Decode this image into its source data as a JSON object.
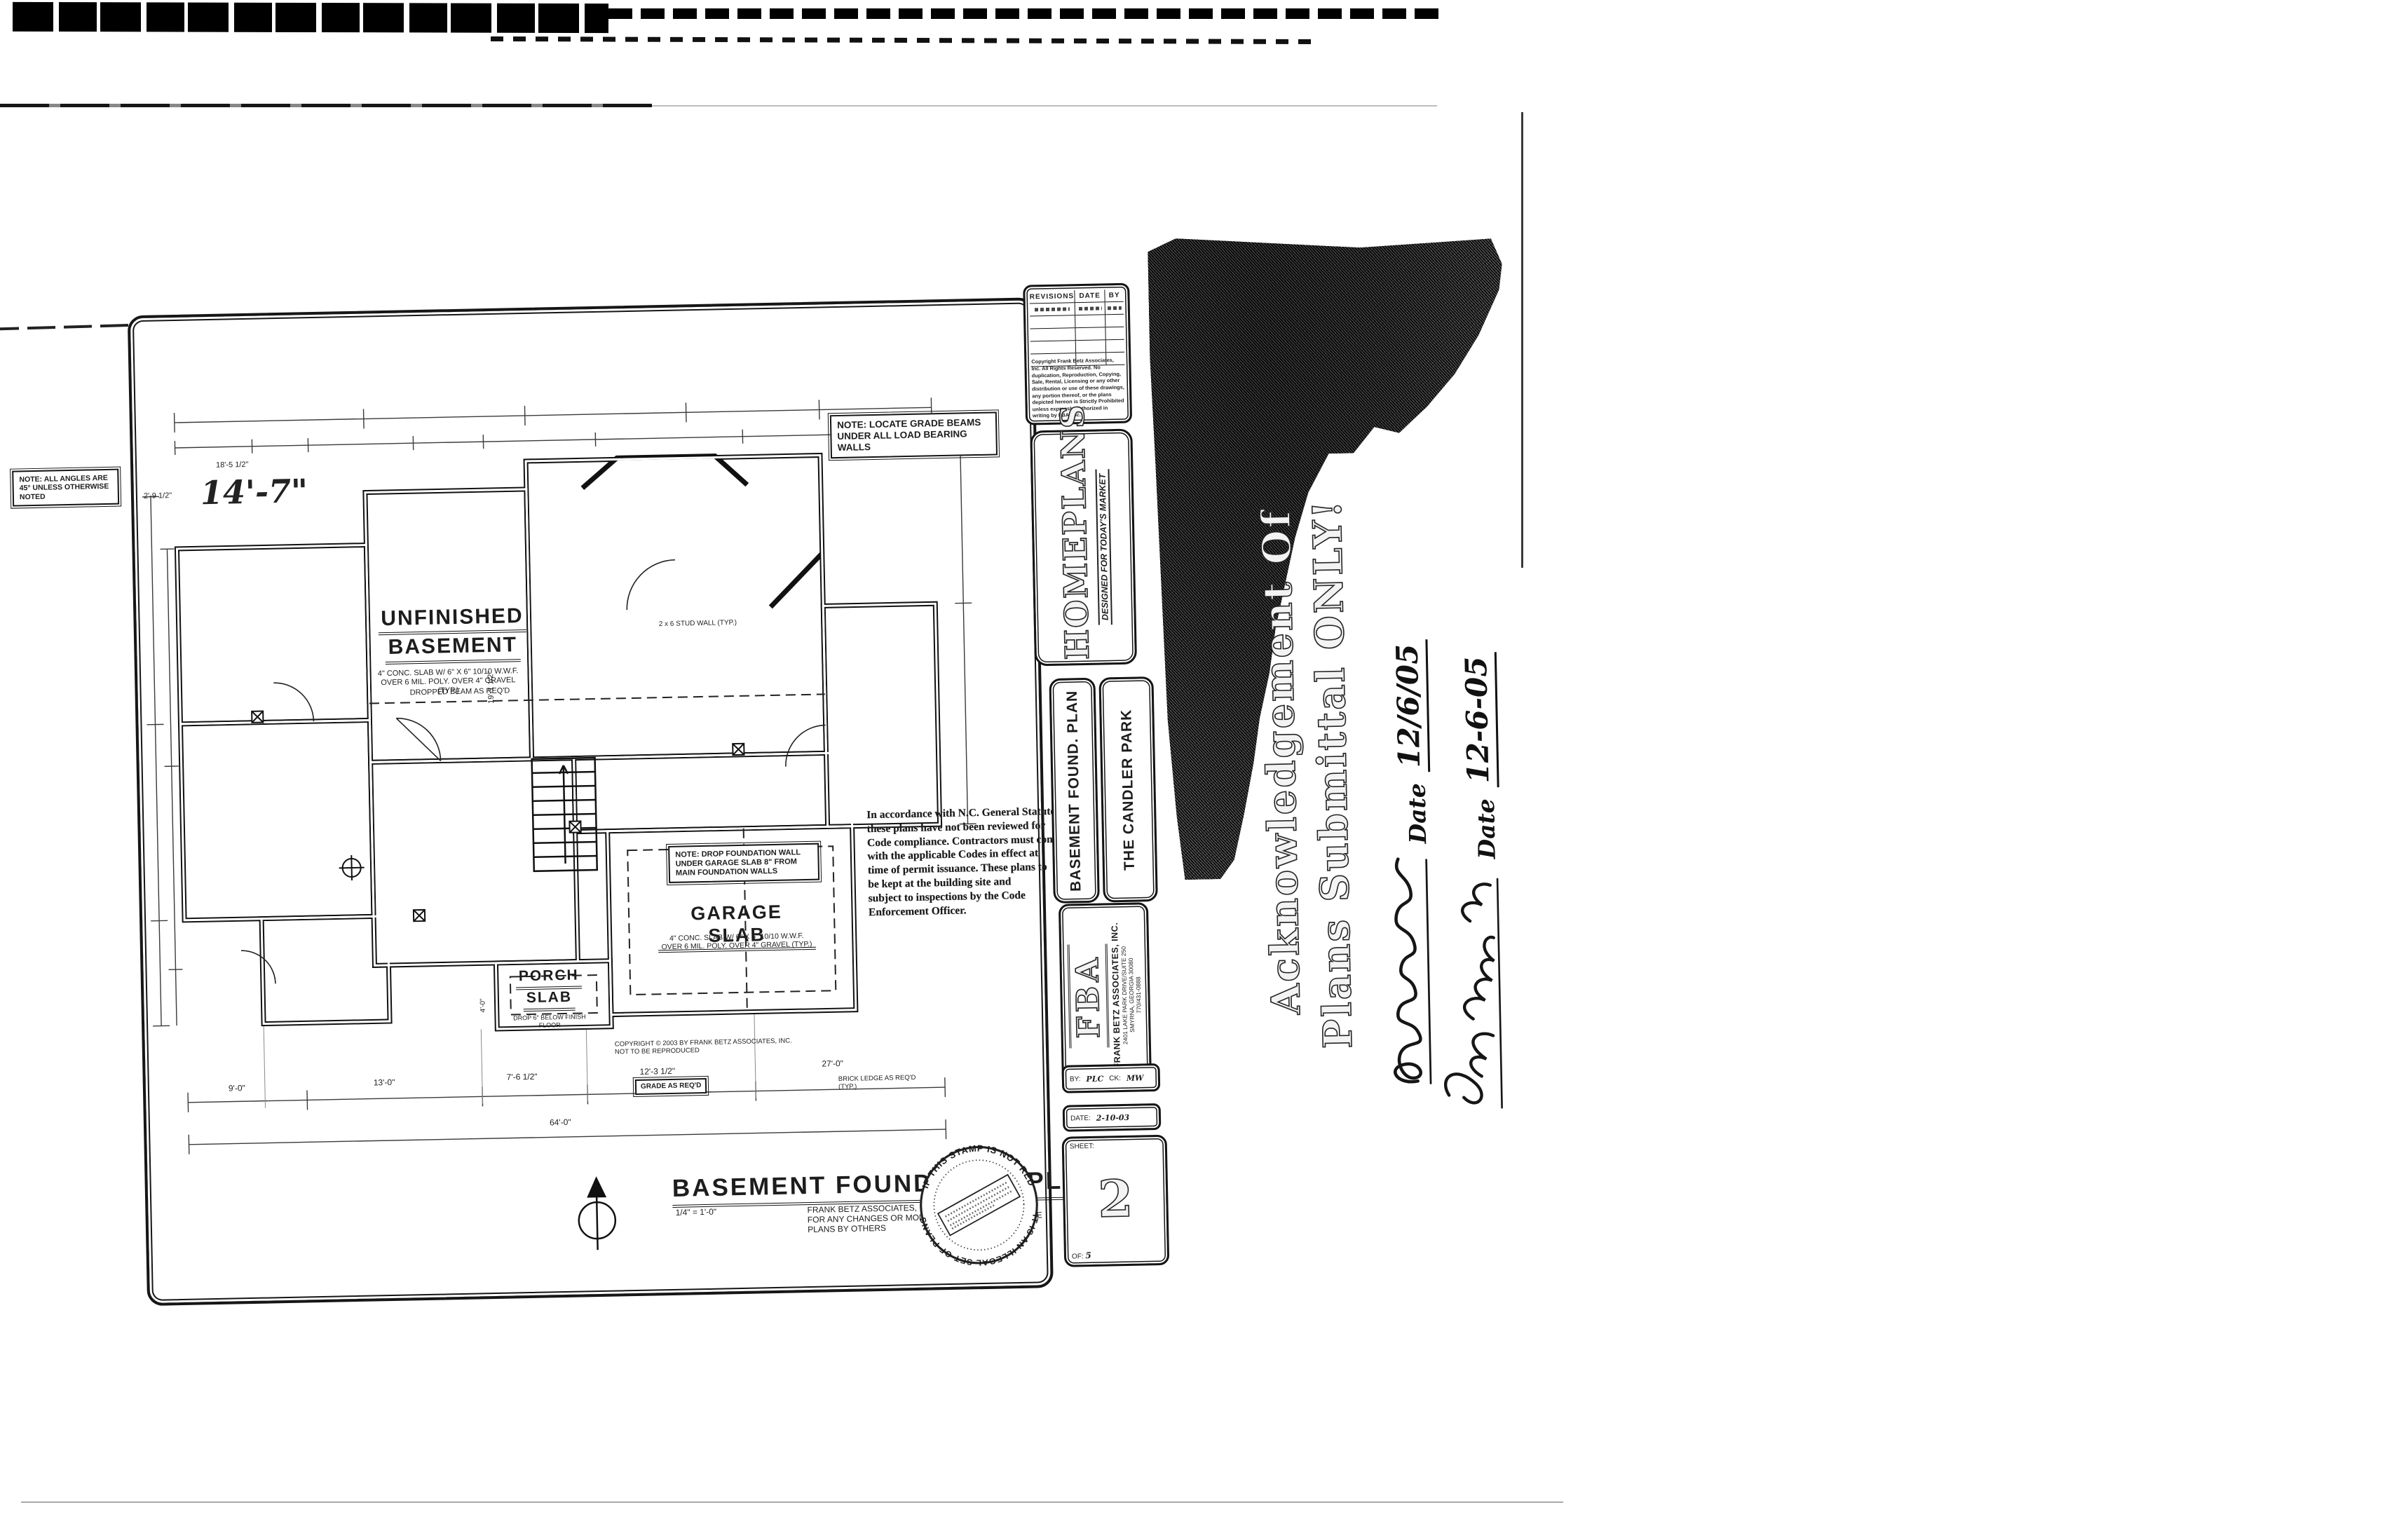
{
  "plan": {
    "handwritten_dim": "14'-7\"",
    "notes": {
      "angles": "NOTE: ALL ANGLES ARE 45° UNLESS OTHERWISE NOTED",
      "grade_beams": "NOTE: LOCATE GRADE BEAMS UNDER ALL LOAD BEARING WALLS",
      "garage_drop": "NOTE: DROP FOUNDATION WALL UNDER GARAGE SLAB 8\" FROM MAIN FOUNDATION WALLS",
      "dropped_beam": "DROPPED BEAM AS REQ'D",
      "stud_wall": "2 x 6 STUD WALL (TYP.)",
      "grade": "GRADE AS REQ'D",
      "brick_ledge": "BRICK LEDGE AS REQ'D (TYP.)",
      "copyright": "COPYRIGHT © 2003 BY FRANK BETZ ASSOCIATES, INC. NOT TO BE REPRODUCED"
    },
    "rooms": {
      "unfinished": {
        "lines": [
          "UNFINISHED",
          "BASEMENT"
        ],
        "note": "4\" CONC. SLAB W/ 6\" X 6\" 10/10 W.W.F. OVER 6 MIL. POLY. OVER 4\" GRAVEL (TYP.)"
      },
      "garage": {
        "lines": [
          "GARAGE SLAB"
        ],
        "note": "4\" CONC. SLAB W/ 6\" X 6\" 10/10 W.W.F. OVER 6 MIL. POLY. OVER 4\" GRAVEL (TYP.)"
      },
      "porch": {
        "lines": [
          "PORCH",
          "SLAB"
        ],
        "note": "DROP 6\" BELOW FINISH FLOOR"
      }
    },
    "dims": {
      "bottom": [
        "9'-0\"",
        "13'-0\"",
        "7'-6 1/2\"",
        "12'-3 1/2\"",
        "27'-0\"",
        "64'-0\""
      ],
      "top_small": "18'-5 1/2\"",
      "left_small": "2'-9 1/2\"",
      "interior_vertical": "19'-1 1/2\"",
      "porch_depth": "4'-0\""
    },
    "title": {
      "text": "BASEMENT FOUNDATION PLAN",
      "scale": "1/4\" = 1'-0\"",
      "disclaimer_lines": [
        "FRANK BETZ ASSOCIATES, INC. ASSUMES NO LIABILITY",
        "FOR ANY CHANGES OR MODIFICATIONS MADE TO THESE",
        "PLANS BY OTHERS"
      ]
    }
  },
  "code_stamp": {
    "lines": [
      "In accordance with N.C. General Statutes",
      "these plans have not been reviewed for",
      "Code compliance. Contractors must comply",
      "with the applicable Codes in effect at",
      "time of permit issuance. These plans to",
      "be kept at the building site and",
      "subject to inspections by the Code",
      "Enforcement Officer."
    ]
  },
  "titleblock": {
    "revisions": {
      "headers": [
        "REVISIONS",
        "DATE",
        "BY"
      ]
    },
    "copyright": "Copyright Frank Betz Associates, Inc. All Rights Reserved. No duplication, Reproduction, Copying, Sale, Rental, Licensing or any other distribution or use of these drawings, any portion thereof, or the plans depicted hereon is Strictly Prohibited unless expressly authorized in writing by FBA, Inc.",
    "brand": {
      "name": "HOMEPLANS",
      "tagline": "DESIGNED FOR TODAY'S MARKET"
    },
    "sheet_name": "BASEMENT FOUND. PLAN",
    "plan_name": "THE CANDLER PARK",
    "firm": {
      "logo": "FBA",
      "name": "FRANK BETZ ASSOCIATES, INC.",
      "address1": "2401 LAKE PARK DRIVE/SUITE 250",
      "address2": "SMYRNA, GEORGIA 30080",
      "phone": "770/431-0888"
    },
    "by_label": "BY:",
    "by_value": "PLC",
    "ck_label": "CK:",
    "ck_value": "MW",
    "date_label": "DATE:",
    "date_value": "2-10-03",
    "sheet_label": "SHEET:",
    "sheet_number": "2",
    "of_label": "OF:",
    "sheet_total": "5"
  },
  "stamp": {
    "top_text": "IF THIS STAMP IS NOT RED",
    "bottom_text": "IT IS AN ILLEGAL SET OF PLANS"
  },
  "annotation": {
    "line1": "Acknowledgement Of",
    "line2": "Plans Submittal ONLY!",
    "date_label": "Date",
    "date1": "12/6/05",
    "date2": "12-6-05"
  }
}
